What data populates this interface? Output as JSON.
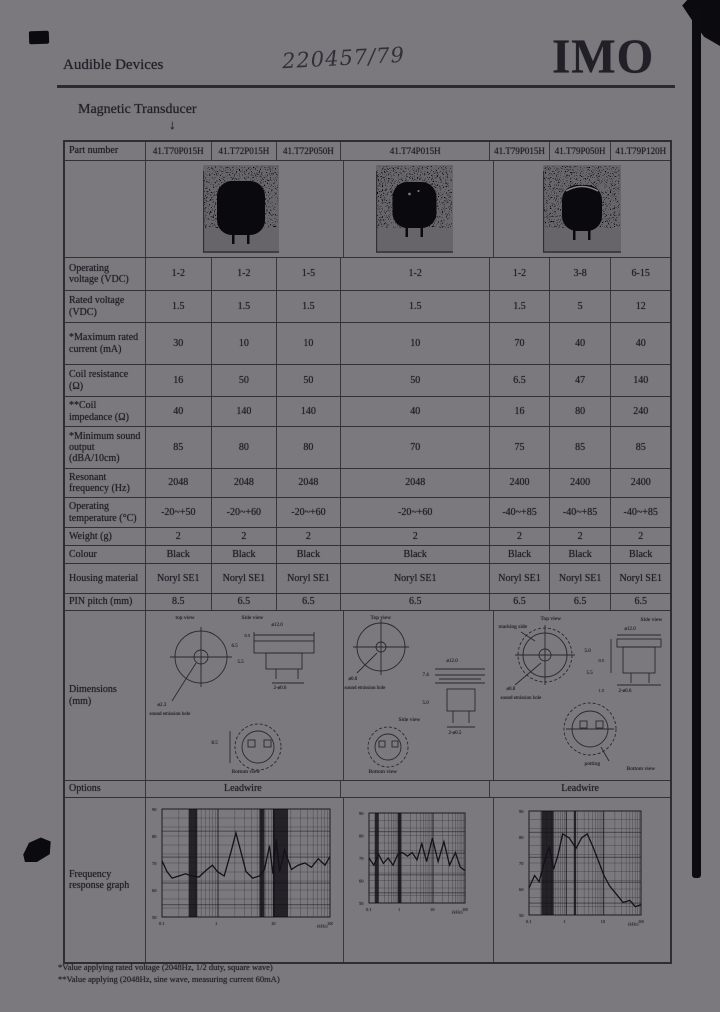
{
  "header": {
    "section": "Audible Devices",
    "handwritten": "220457/79",
    "brand": "IMO",
    "title": "Magnetic Transducer",
    "arrow": "↓"
  },
  "table": {
    "part_number_label": "Part number",
    "part_numbers": [
      "41.T70P015H",
      "41.T72P015H",
      "41.T72P050H",
      "41.T74P015H",
      "41.T79P015H",
      "41.T79P050H",
      "41.T79P120H"
    ],
    "rows": [
      {
        "label": "Operating voltage (VDC)",
        "values": [
          "1-2",
          "1-2",
          "1-5",
          "1-2",
          "1-2",
          "3-8",
          "6-15"
        ]
      },
      {
        "label": "Rated voltage (VDC)",
        "values": [
          "1.5",
          "1.5",
          "1.5",
          "1.5",
          "1.5",
          "5",
          "12"
        ]
      },
      {
        "label": "*Maximum rated current (mA)",
        "values": [
          "30",
          "10",
          "10",
          "10",
          "70",
          "40",
          "40"
        ]
      },
      {
        "label": "Coil resistance (Ω)",
        "values": [
          "16",
          "50",
          "50",
          "50",
          "6.5",
          "47",
          "140"
        ]
      },
      {
        "label": "**Coil impedance (Ω)",
        "values": [
          "40",
          "140",
          "140",
          "40",
          "16",
          "80",
          "240"
        ]
      },
      {
        "label": "*Minimum sound output (dBA/10cm)",
        "values": [
          "85",
          "80",
          "80",
          "70",
          "75",
          "85",
          "85"
        ]
      },
      {
        "label": "Resonant frequency (Hz)",
        "values": [
          "2048",
          "2048",
          "2048",
          "2048",
          "2400",
          "2400",
          "2400"
        ]
      },
      {
        "label": "Operating temperature (°C)",
        "values": [
          "-20~+50",
          "-20~+60",
          "-20~+60",
          "-20~+60",
          "-40~+85",
          "-40~+85",
          "-40~+85"
        ]
      },
      {
        "label": "Weight (g)",
        "values": [
          "2",
          "2",
          "2",
          "2",
          "2",
          "2",
          "2"
        ]
      },
      {
        "label": "Colour",
        "values": [
          "Black",
          "Black",
          "Black",
          "Black",
          "Black",
          "Black",
          "Black"
        ]
      },
      {
        "label": "Housing material",
        "values": [
          "Noryl SE1",
          "Noryl SE1",
          "Noryl SE1",
          "Noryl SE1",
          "Noryl SE1",
          "Noryl SE1",
          "Noryl SE1"
        ]
      },
      {
        "label": "PIN pitch (mm)",
        "values": [
          "8.5",
          "6.5",
          "6.5",
          "6.5",
          "6.5",
          "6.5",
          "6.5"
        ]
      }
    ]
  },
  "dimensions": {
    "label": "Dimensions (mm)",
    "p1": {
      "top_view": "top view",
      "side_view": "Side view",
      "hole_dia": "ø2.3",
      "hole_note": "sound emission hole",
      "body_dia": "ø12.0",
      "h1": "6.5",
      "h2": "0.5",
      "h3": "5.5",
      "pins": "2-ø0.6",
      "pitch": "8.5",
      "bottom_view": "Bottom view"
    },
    "p2": {
      "top_view": "Top view",
      "hole_dia": "ø0.8",
      "hole_note": "sound emission hole",
      "body_dia": "ø12.0",
      "h1": "7.4",
      "h2": "5.0",
      "side_view": "Side view",
      "pins": "2-ø0.5",
      "bottom_view": "Bottom view"
    },
    "p3": {
      "marking": "marking side",
      "top_view": "Top view",
      "side_view": "Side view",
      "body_dia": "ø12.0",
      "h1": "5.0",
      "h2": "0.5",
      "h3": "5.5",
      "h4": "1.5",
      "pins": "2-ø0.6",
      "hole_dia": "ø0.8",
      "hole_note": "sound emission hole",
      "potting": "potting",
      "bottom_view": "Bottom view"
    }
  },
  "options": {
    "label": "Options",
    "left": "Leadwire",
    "right": "Leadwire"
  },
  "freq": {
    "label": "Frequency response graph"
  },
  "graphs": {
    "axis": {
      "y_ticks": [
        "90",
        "80",
        "70",
        "60",
        "50"
      ],
      "x_ticks": [
        "0.1",
        "1",
        "10",
        "100"
      ],
      "x_unit": "(kHz)"
    },
    "g1": {
      "curve": [
        [
          0,
          48
        ],
        [
          3,
          58
        ],
        [
          6,
          64
        ],
        [
          10,
          62
        ],
        [
          14,
          60
        ],
        [
          18,
          62
        ],
        [
          22,
          63
        ],
        [
          26,
          57
        ],
        [
          30,
          52
        ],
        [
          33,
          58
        ],
        [
          37,
          62
        ],
        [
          41,
          40
        ],
        [
          44,
          22
        ],
        [
          47,
          40
        ],
        [
          50,
          58
        ],
        [
          54,
          64
        ],
        [
          58,
          62
        ],
        [
          61,
          56
        ],
        [
          64,
          34
        ],
        [
          66,
          60
        ],
        [
          68,
          28
        ],
        [
          70,
          58
        ],
        [
          73,
          38
        ],
        [
          77,
          56
        ],
        [
          81,
          52
        ],
        [
          85,
          50
        ],
        [
          89,
          54
        ],
        [
          93,
          46
        ],
        [
          97,
          52
        ],
        [
          100,
          44
        ]
      ],
      "bands": [
        [
          16,
          5
        ],
        [
          58,
          3
        ],
        [
          66,
          9
        ]
      ]
    },
    "g2": {
      "curve": [
        [
          0,
          50
        ],
        [
          5,
          58
        ],
        [
          10,
          46
        ],
        [
          15,
          56
        ],
        [
          20,
          50
        ],
        [
          25,
          58
        ],
        [
          30,
          46
        ],
        [
          35,
          44
        ],
        [
          40,
          48
        ],
        [
          45,
          44
        ],
        [
          50,
          52
        ],
        [
          55,
          34
        ],
        [
          60,
          54
        ],
        [
          66,
          28
        ],
        [
          72,
          54
        ],
        [
          78,
          32
        ],
        [
          84,
          58
        ],
        [
          90,
          44
        ],
        [
          95,
          60
        ],
        [
          100,
          64
        ]
      ],
      "bands": [
        [
          6,
          4
        ],
        [
          30,
          3
        ]
      ]
    },
    "g3": {
      "curve": [
        [
          0,
          74
        ],
        [
          5,
          62
        ],
        [
          9,
          68
        ],
        [
          14,
          48
        ],
        [
          18,
          34
        ],
        [
          22,
          56
        ],
        [
          26,
          42
        ],
        [
          30,
          22
        ],
        [
          36,
          26
        ],
        [
          42,
          36
        ],
        [
          47,
          26
        ],
        [
          52,
          22
        ],
        [
          57,
          34
        ],
        [
          62,
          48
        ],
        [
          67,
          62
        ],
        [
          72,
          72
        ],
        [
          78,
          80
        ],
        [
          84,
          88
        ],
        [
          90,
          86
        ],
        [
          95,
          92
        ],
        [
          100,
          90
        ]
      ],
      "bands": [
        [
          11,
          11
        ],
        [
          40,
          2
        ]
      ]
    }
  },
  "footnotes": [
    "*Value applying rated voltage (2048Hz, 1/2 duty, square wave)",
    "**Value applying (2048Hz, sine wave, measuring current 60mA)"
  ]
}
